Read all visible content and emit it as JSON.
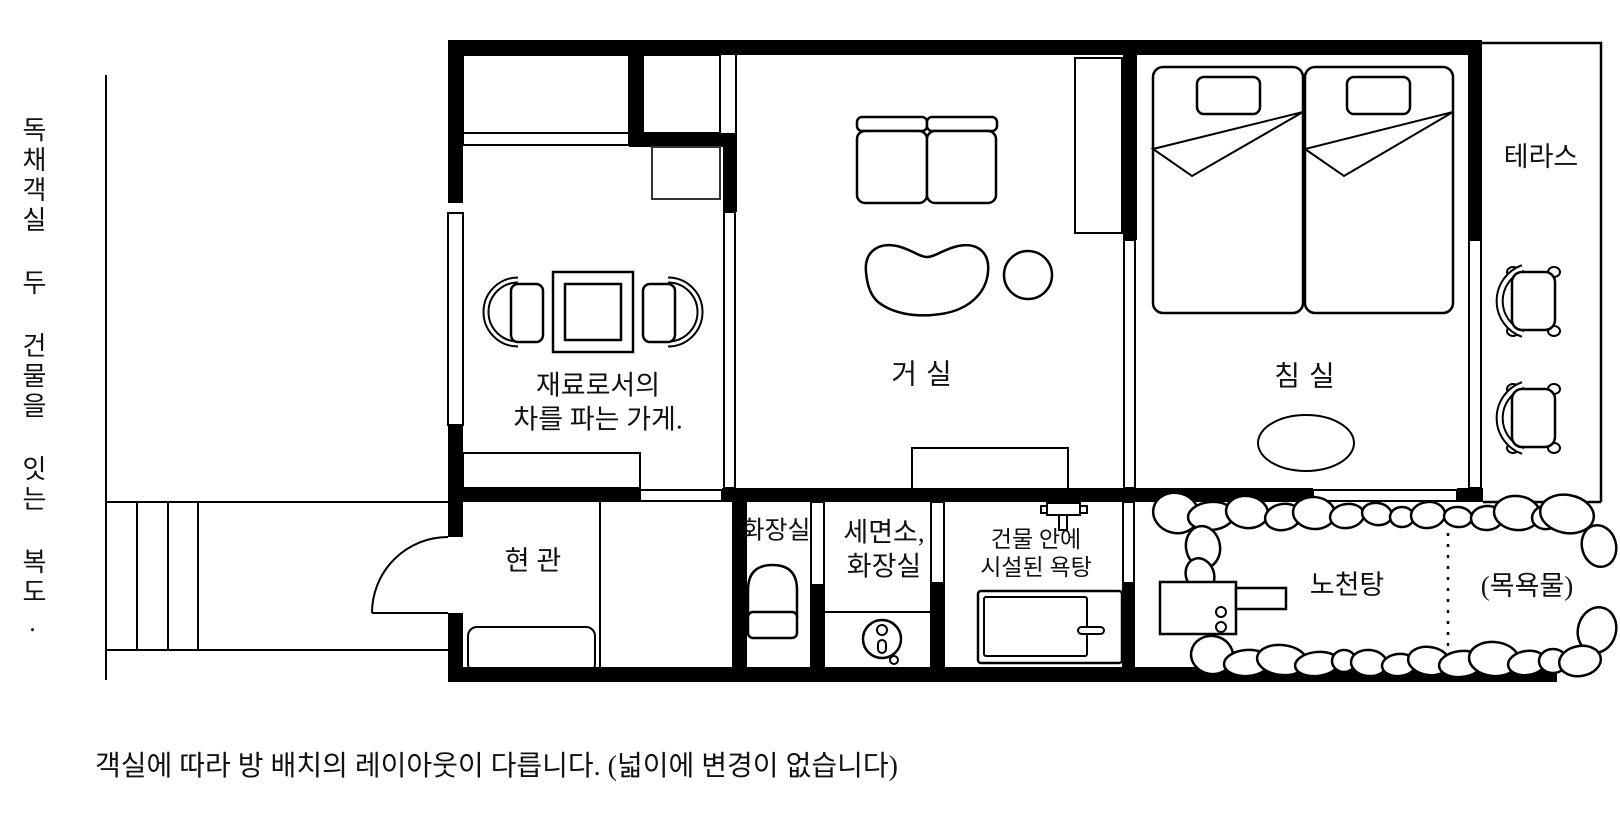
{
  "plan": {
    "title_note_vertical": "독채객실 두 건물을 잇는 복도.",
    "caption": "객실에 따라 방 배치의 레이아웃이 다릅니다. (넓이에 변경이 없습니다)",
    "line_color": "#000000",
    "background": "#ffffff"
  },
  "rooms": {
    "tea_shop": {
      "line1": "재료로서의",
      "line2": "차를 파는 가게."
    },
    "living_room": {
      "label": "거 실"
    },
    "bedroom": {
      "label": "침 실"
    },
    "terrace": {
      "label": "테라스"
    },
    "entrance": {
      "label": "현 관"
    },
    "toilet": {
      "label": "화장실"
    },
    "washroom": {
      "line1": "세면소,",
      "line2": "화장실"
    },
    "indoor_bath": {
      "line1": "건물 안에",
      "line2": "시설된 욕탕"
    },
    "open_air_bath": {
      "label": "노천탕"
    },
    "bath_water": {
      "label": "(목욕물)"
    }
  }
}
